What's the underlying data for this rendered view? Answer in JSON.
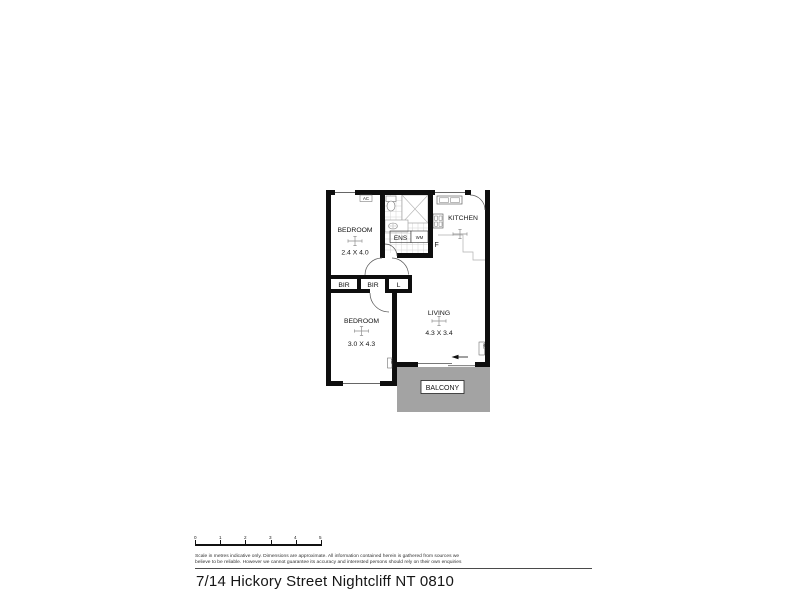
{
  "address": "7/14 Hickory Street Nightcliff NT 0810",
  "disclaimer": {
    "line1": "Scale in metres indicative only. Dimensions are approximate. All information contained herein is gathered from sources we",
    "line2": "believe to be reliable. However we cannot guarantee its accuracy and interested persons should rely on their own enquiries"
  },
  "scalebar": {
    "ticks": [
      "0",
      "1",
      "2",
      "3",
      "4",
      "5"
    ]
  },
  "floorplan": {
    "bedroom1": {
      "label": "BEDROOM",
      "dims": "2.4 X 4.0"
    },
    "bedroom2": {
      "label": "BEDROOM",
      "dims": "3.0 X 4.3"
    },
    "living": {
      "label": "LIVING",
      "dims": "4.3 X 3.4"
    },
    "kitchen": {
      "label": "KITCHEN"
    },
    "ens": {
      "label": "ENS"
    },
    "balcony": {
      "label": "BALCONY"
    },
    "storage": {
      "bir1": "BIR",
      "bir2": "BIR",
      "linen": "L"
    },
    "appliances": {
      "ac": "AC",
      "ac_bed2": "AC",
      "ac_living": "AC",
      "wm": "WM",
      "fridge": "F"
    },
    "colors": {
      "wall": "#0e0e0e",
      "balcony_fill": "#a3a3a3",
      "tile_line": "#d4d4d4"
    }
  }
}
